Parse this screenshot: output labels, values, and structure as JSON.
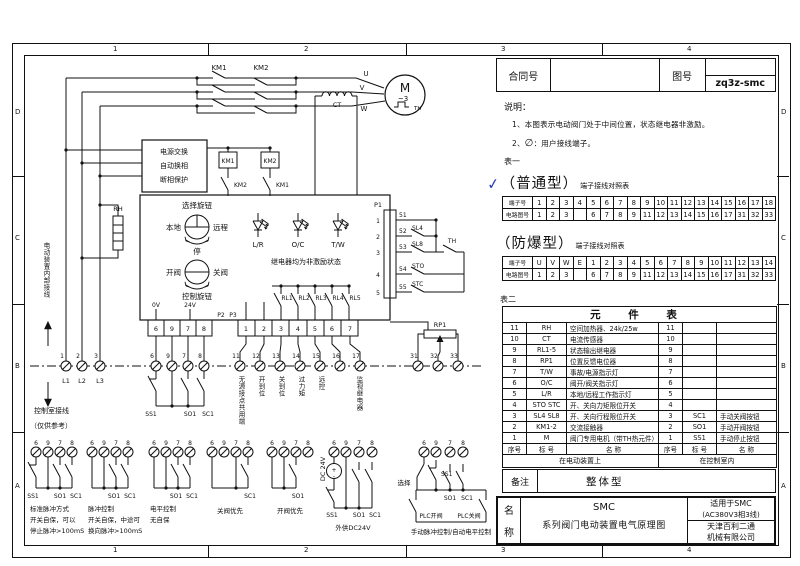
{
  "frame": {
    "top_zones": [
      "1",
      "2",
      "3",
      "4"
    ],
    "bottom_zones": [
      "1",
      "2",
      "3",
      "4"
    ],
    "left_zones": [
      "D",
      "C",
      "B",
      "A"
    ],
    "right_zones": [
      "D",
      "C",
      "B",
      "A"
    ]
  },
  "title_block": {
    "contract_label": "合同号",
    "contract_value": "",
    "drawing_label": "图号",
    "drawing_value": "zq3z-smc"
  },
  "notes": {
    "heading": "说明：",
    "item1": "1、本图表示电动阀门处于中间位置，状态继电器非激励。",
    "item2_prefix": "2、",
    "item2_symbol": "∅",
    "item2_text": "：用户接线端子。"
  },
  "table1_label": "表一",
  "table2_label": "表二",
  "ordinary": {
    "check": "✓",
    "title": "（普通型）",
    "subtitle": "端子接线对照表",
    "row1_label": "端子号",
    "row2_label": "电路图号",
    "row1": [
      "1",
      "2",
      "3",
      "4",
      "5",
      "6",
      "7",
      "8",
      "9",
      "10",
      "11",
      "12",
      "13",
      "14",
      "15",
      "16",
      "17",
      "18"
    ],
    "row2": [
      "1",
      "2",
      "3",
      "",
      "6",
      "7",
      "8",
      "9",
      "11",
      "12",
      "13",
      "14",
      "15",
      "16",
      "17",
      "31",
      "32",
      "33"
    ]
  },
  "explosion": {
    "title": "（防爆型）",
    "subtitle": "端子接线对照表",
    "row1_label": "端子号",
    "row2_label": "电路图号",
    "row1": [
      "U",
      "V",
      "W",
      "E",
      "1",
      "2",
      "3",
      "4",
      "5",
      "6",
      "7",
      "8",
      "9",
      "10",
      "11",
      "12",
      "13",
      "14"
    ],
    "row2": [
      "1",
      "2",
      "3",
      "",
      "6",
      "7",
      "8",
      "9",
      "11",
      "12",
      "13",
      "14",
      "15",
      "16",
      "17",
      "31",
      "32",
      "33"
    ]
  },
  "components": {
    "title": "元 件 表",
    "rows": [
      {
        "no": "11",
        "tag": "RH",
        "name": "空间加热器、24k/25w",
        "no2": "11",
        "tag2": "",
        "name2": ""
      },
      {
        "no": "10",
        "tag": "CT",
        "name": "电流传感器",
        "no2": "10",
        "tag2": "",
        "name2": ""
      },
      {
        "no": "9",
        "tag": "RL1-5",
        "name": "状态输出继电器",
        "no2": "9",
        "tag2": "",
        "name2": ""
      },
      {
        "no": "8",
        "tag": "RP1",
        "name": "位置反馈电位器",
        "no2": "8",
        "tag2": "",
        "name2": ""
      },
      {
        "no": "7",
        "tag": "T/W",
        "name": "事故/电源指示灯",
        "no2": "7",
        "tag2": "",
        "name2": ""
      },
      {
        "no": "6",
        "tag": "O/C",
        "name": "阀开/阀关指示灯",
        "no2": "6",
        "tag2": "",
        "name2": ""
      },
      {
        "no": "5",
        "tag": "L/R",
        "name": "本地/远程工作指示灯",
        "no2": "5",
        "tag2": "",
        "name2": ""
      },
      {
        "no": "4",
        "tag": "STO STC",
        "name": "开、关向力矩限位开关",
        "no2": "4",
        "tag2": "",
        "name2": ""
      },
      {
        "no": "3",
        "tag": "SL4 SL8",
        "name": "开、关向行程限位开关",
        "no2": "3",
        "tag2": "SC1",
        "name2": "手动关阀按钮"
      },
      {
        "no": "2",
        "tag": "KM1-2",
        "name": "交流接触器",
        "no2": "2",
        "tag2": "SO1",
        "name2": "手动开阀按钮"
      },
      {
        "no": "1",
        "tag": "M",
        "name": "阀门专用电机（带TH热元件）",
        "no2": "1",
        "tag2": "SS1",
        "name2": "手动停止按钮"
      }
    ],
    "header": [
      "序号",
      "标 号",
      "名    称",
      "序号",
      "标 号",
      "名    称"
    ],
    "left_location": "在电动装置上",
    "right_location": "在控制室内"
  },
  "remark": {
    "label": "备注",
    "value": "整体型"
  },
  "name_block": {
    "label_top": "名",
    "label_bottom": "称",
    "line1": "SMC",
    "line2": "系列阀门电动装置电气原理图",
    "apply1": "适用于SMC",
    "apply2": "(AC380V3相3线)",
    "company1": "天津百利二通",
    "company2": "机械有限公司"
  },
  "sch": {
    "km1": "KM1",
    "km2": "KM2",
    "u": "U",
    "v": "V",
    "w": "W",
    "m": "M",
    "m3": "~3",
    "th": "TH",
    "ct": "CT",
    "rh": "RH",
    "pwr1": "电源交换",
    "pwr2": "自动换相",
    "pwr3": "断相保护",
    "internal": "电动装置内部接线",
    "ctrl_room": "控制室接线",
    "ctrl_room2": "（仅供参考）",
    "sel_knob": "选择旋钮",
    "local": "本地",
    "remote": "远程",
    "stop": "停",
    "open": "开阀",
    "close": "关阀",
    "ctrl_knob": "控制旋钮",
    "lr": "L/R",
    "oc": "O/C",
    "tw": "T/W",
    "relay_note": "继电器均为非激励状态",
    "rl": [
      "RL1",
      "RL2",
      "RL3",
      "RL4",
      "RL5"
    ],
    "v0": "0V",
    "v24": "24V",
    "p1": "P1",
    "p2": "P2",
    "p3": "P3",
    "p2_cells": [
      "6",
      "9",
      "7",
      "8"
    ],
    "p3_cells": [
      "1",
      "2",
      "3",
      "4",
      "5",
      "6",
      "7"
    ],
    "p1_pins": [
      "1",
      "2",
      "3",
      "4",
      "5"
    ],
    "t51": [
      "51",
      "52",
      "53",
      "54",
      "55"
    ],
    "sl4": "SL4",
    "sl8": "SL8",
    "sto": "STO",
    "stc": "STC",
    "rp1": "RP1",
    "t123": [
      "1",
      "2",
      "3"
    ],
    "l123": [
      "L1",
      "L2",
      "L3"
    ],
    "t6978": [
      "6",
      "9",
      "7",
      "8"
    ],
    "t11_17": [
      "11",
      "12",
      "13",
      "14",
      "15",
      "16",
      "17"
    ],
    "t313233": [
      "31",
      "32",
      "33"
    ],
    "ann": {
      "a11": "无源接点共用端",
      "a12": "开到位",
      "a13": "关到位",
      "a14": "过力矩",
      "a15": "远控",
      "a17": "监视继电器"
    },
    "ss1": "SS1",
    "so1": "SO1",
    "sc1": "SC1",
    "dc24": "DC 24V",
    "plus": "+",
    "minus": "-",
    "select": "选择",
    "plc_open": "PLC开阀",
    "plc_close": "PLC关阀",
    "groups": [
      {
        "caption": [
          "标准脉冲方式",
          "开关自保，可以",
          "停止脉冲>100mS"
        ]
      },
      {
        "caption": [
          "脉冲控制",
          "开关自保，中途可",
          "换向脉冲>100mS"
        ]
      },
      {
        "caption": [
          "电平控制",
          "无自保"
        ]
      },
      {
        "caption": [
          "关阀优先"
        ]
      },
      {
        "caption": [
          "开阀优先"
        ]
      },
      {
        "caption": [
          "外供DC24V"
        ]
      },
      {
        "caption": [
          "手动脉冲控制/自动电平控制"
        ]
      }
    ]
  }
}
